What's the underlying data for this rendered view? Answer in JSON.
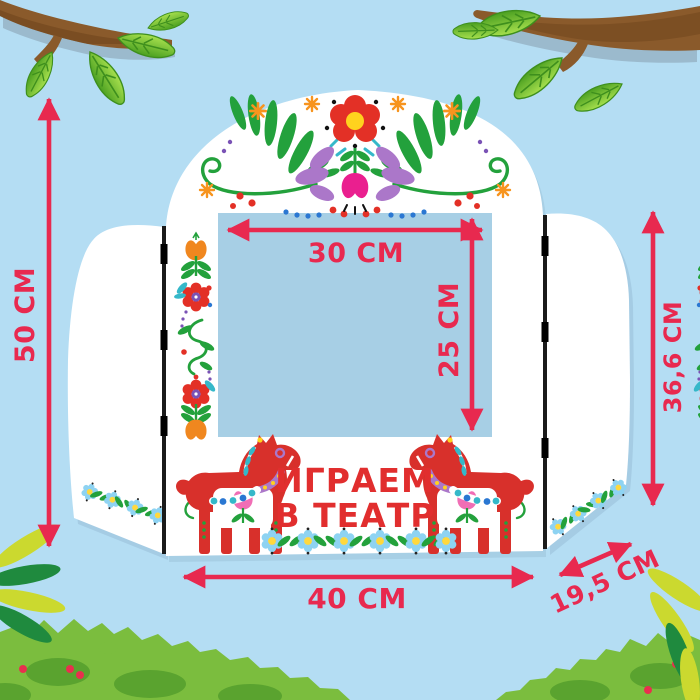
{
  "theater": {
    "title_line1": "ИГРАЕМ",
    "title_line2": "В ТЕАТР"
  },
  "dimension_labels": {
    "overall_height": "50 СМ",
    "window_width": "30 СМ",
    "window_height": "25 СМ",
    "wing_height": "36,6 СМ",
    "overall_width": "40 СМ",
    "wing_width": "19,5 СМ"
  },
  "colors": {
    "sky": "#b4ddf3",
    "dimension_accent": "#e8294f",
    "title_red": "#e12e2e",
    "panel_white": "#ffffff",
    "ornament_green": "#23a13c",
    "ornament_red": "#e33026",
    "ornament_orange": "#f7941e",
    "ornament_purple": "#ab77c9",
    "ornament_magenta": "#ea1f8f",
    "ornament_blue": "#2a77d2",
    "ornament_teal": "#35b8c9",
    "flower_lightblue": "#8ed3f2",
    "flower_yellow": "#ffd83d",
    "horse_red": "#d8302b",
    "grass_green": "#7bbd3e",
    "grass_dark_green": "#5aa32f",
    "plant_yellow_green": "#cbd92f",
    "branch_brown": "#8a5a2b"
  },
  "decor_icons": [
    "tree-branch-icon",
    "leaf-icon",
    "folk-flower-icon",
    "tulip-icon",
    "feather-swirl-icon",
    "asterisk-icon",
    "dala-horse-icon",
    "daisy-garland-icon",
    "hinge-icon",
    "grass-bush-icon",
    "berry-icon",
    "plant-leaves-icon"
  ]
}
